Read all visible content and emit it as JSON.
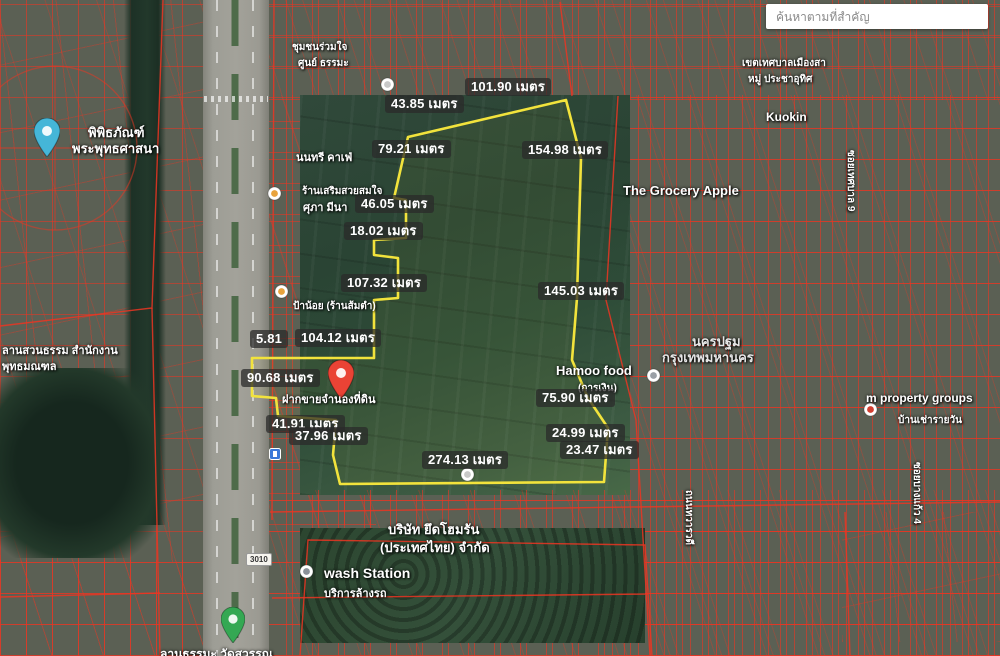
{
  "search": {
    "placeholder": "ค้นหาตามที่สำคัญ"
  },
  "units": "เมตร",
  "colors": {
    "plot_outline": "#f2e33c",
    "cadastral_red": "#ec3522",
    "marker_red": "#ea4335",
    "pin_blue": "#45b6d8",
    "pin_green": "#34a853"
  },
  "plot_outline": {
    "points": "408,137 566,100 581,158 577,298 572,360 588,398 608,428 604,482 340,484 333,455 336,420 278,416 276,398 252,396 252,358 374,358 374,300 398,298 398,258 374,255 374,240 406,238 406,200 394,198 408,137"
  },
  "measurements": [
    {
      "text": "101.90 เมตร",
      "x": 465,
      "y": 78
    },
    {
      "text": "43.85 เมตร",
      "x": 385,
      "y": 95
    },
    {
      "text": "79.21 เมตร",
      "x": 372,
      "y": 140
    },
    {
      "text": "154.98 เมตร",
      "x": 522,
      "y": 141
    },
    {
      "text": "46.05 เมตร",
      "x": 355,
      "y": 195
    },
    {
      "text": "18.02 เมตร",
      "x": 344,
      "y": 222
    },
    {
      "text": "107.32 เมตร",
      "x": 341,
      "y": 274
    },
    {
      "text": "145.03 เมตร",
      "x": 538,
      "y": 282
    },
    {
      "text": "5.81",
      "x": 250,
      "y": 330
    },
    {
      "text": "104.12 เมตร",
      "x": 295,
      "y": 329
    },
    {
      "text": "90.68 เมตร",
      "x": 241,
      "y": 369
    },
    {
      "text": "41.91 เมตร",
      "x": 266,
      "y": 415
    },
    {
      "text": "37.96 เมตร",
      "x": 289,
      "y": 427
    },
    {
      "text": "75.90 เมตร",
      "x": 536,
      "y": 389
    },
    {
      "text": "24.99 เมตร",
      "x": 546,
      "y": 424
    },
    {
      "text": "23.47 เมตร",
      "x": 560,
      "y": 441
    },
    {
      "text": "274.13 เมตร",
      "x": 422,
      "y": 451
    }
  ],
  "poi_labels": [
    {
      "text": "พิพิธภัณฑ์",
      "x": 88,
      "y": 122,
      "s": 13
    },
    {
      "text": "พระพุทธศาสนา",
      "x": 72,
      "y": 138,
      "s": 13
    },
    {
      "text": "ลานสวนธรรม สำนักงาน",
      "x": 2,
      "y": 341,
      "s": 11
    },
    {
      "text": "พุทธมณฑล",
      "x": 2,
      "y": 357,
      "s": 11
    },
    {
      "text": "ชุมชนร่วมใจ",
      "x": 292,
      "y": 40,
      "s": 10
    },
    {
      "text": "ศูนย์ ธรรมะ",
      "x": 298,
      "y": 56,
      "s": 10
    },
    {
      "text": "นนทรี คาเฟ่",
      "x": 296,
      "y": 148,
      "s": 11
    },
    {
      "text": "ร้านเสริมสวยสมใจ",
      "x": 302,
      "y": 184,
      "s": 10
    },
    {
      "text": "ศุภา มีนา",
      "x": 303,
      "y": 198,
      "s": 11
    },
    {
      "text": "ป้าน้อย (ร้านส้มตำ)",
      "x": 293,
      "y": 299,
      "s": 10
    },
    {
      "text": "The Grocery Apple",
      "x": 623,
      "y": 183,
      "s": 13
    },
    {
      "text": "Kuokin",
      "x": 766,
      "y": 110,
      "s": 12
    },
    {
      "text": "Hamoo food",
      "x": 556,
      "y": 363,
      "s": 13
    },
    {
      "text": "(การเงิน)",
      "x": 578,
      "y": 381,
      "s": 10
    },
    {
      "text": "นครปฐม",
      "x": 692,
      "y": 331,
      "s": 13,
      "c": "#e6e6e6"
    },
    {
      "text": "กรุงเทพมหานคร",
      "x": 662,
      "y": 347,
      "s": 13,
      "c": "#e6e6e6"
    },
    {
      "text": "m property groups",
      "x": 866,
      "y": 391,
      "s": 12
    },
    {
      "text": "บ้านเช่ารายวัน",
      "x": 898,
      "y": 413,
      "s": 10
    },
    {
      "text": "wash Station",
      "x": 324,
      "y": 565,
      "s": 14
    },
    {
      "text": "บริการล้างรถ",
      "x": 324,
      "y": 584,
      "s": 11
    },
    {
      "text": "บริษัท ยึดโฮมรัน",
      "x": 388,
      "y": 519,
      "s": 13
    },
    {
      "text": "(ประเทศไทย) จำกัด",
      "x": 380,
      "y": 537,
      "s": 13
    },
    {
      "text": "ฝากขายจำนองที่ดิน",
      "x": 282,
      "y": 390,
      "s": 11
    },
    {
      "text": "เขตเทศบาลเมืองสา",
      "x": 742,
      "y": 56,
      "s": 10
    },
    {
      "text": "หมู่ ประชาอุทิศ",
      "x": 748,
      "y": 72,
      "s": 10
    },
    {
      "text": "ลานธรรมะ วัดสุวรรณ",
      "x": 160,
      "y": 645,
      "s": 12
    },
    {
      "text": "ถนนทวารวดี",
      "x": 696,
      "y": 490,
      "s": 10,
      "rot": 90
    },
    {
      "text": "ซอยบางแก้ว 4",
      "x": 924,
      "y": 462,
      "s": 10,
      "rot": 90
    },
    {
      "text": "ซอยเทศบาล 9",
      "x": 858,
      "y": 150,
      "s": 10,
      "rot": 90
    }
  ],
  "icons": [
    {
      "name": "museum-pin-icon",
      "type": "pin",
      "color": "#45b6d8",
      "x": 34,
      "y": 118,
      "w": 26
    },
    {
      "name": "selected-place-marker-icon",
      "type": "pin",
      "color": "#ea4335",
      "x": 328,
      "y": 360,
      "w": 26
    },
    {
      "name": "park-pin-icon",
      "type": "pin",
      "color": "#34a853",
      "x": 221,
      "y": 607,
      "w": 24
    },
    {
      "name": "carwash-poi-icon",
      "type": "dot",
      "color": "#8a9199",
      "x": 299,
      "y": 564
    },
    {
      "name": "hamoo-food-poi-icon",
      "type": "dot",
      "color": "#9aa0a6",
      "x": 646,
      "y": 368
    },
    {
      "name": "property-poi-icon",
      "type": "dot",
      "color": "#d23f31",
      "x": 863,
      "y": 402
    },
    {
      "name": "restaurant-poi-icon",
      "type": "dot",
      "color": "#e8a33d",
      "x": 267,
      "y": 186
    },
    {
      "name": "somtam-poi-icon",
      "type": "dot",
      "color": "#e8a33d",
      "x": 274,
      "y": 284
    },
    {
      "name": "field-poi-icon",
      "type": "dot",
      "color": "#c8c8c8",
      "x": 460,
      "y": 467
    },
    {
      "name": "top-poi-icon",
      "type": "dot",
      "color": "#c8c8c8",
      "x": 380,
      "y": 77
    },
    {
      "name": "transit-stop-icon",
      "type": "square",
      "color": "#3a78d8",
      "x": 269,
      "y": 447
    },
    {
      "name": "route-badge",
      "type": "badge",
      "text": "3010",
      "x": 246,
      "y": 553
    }
  ]
}
